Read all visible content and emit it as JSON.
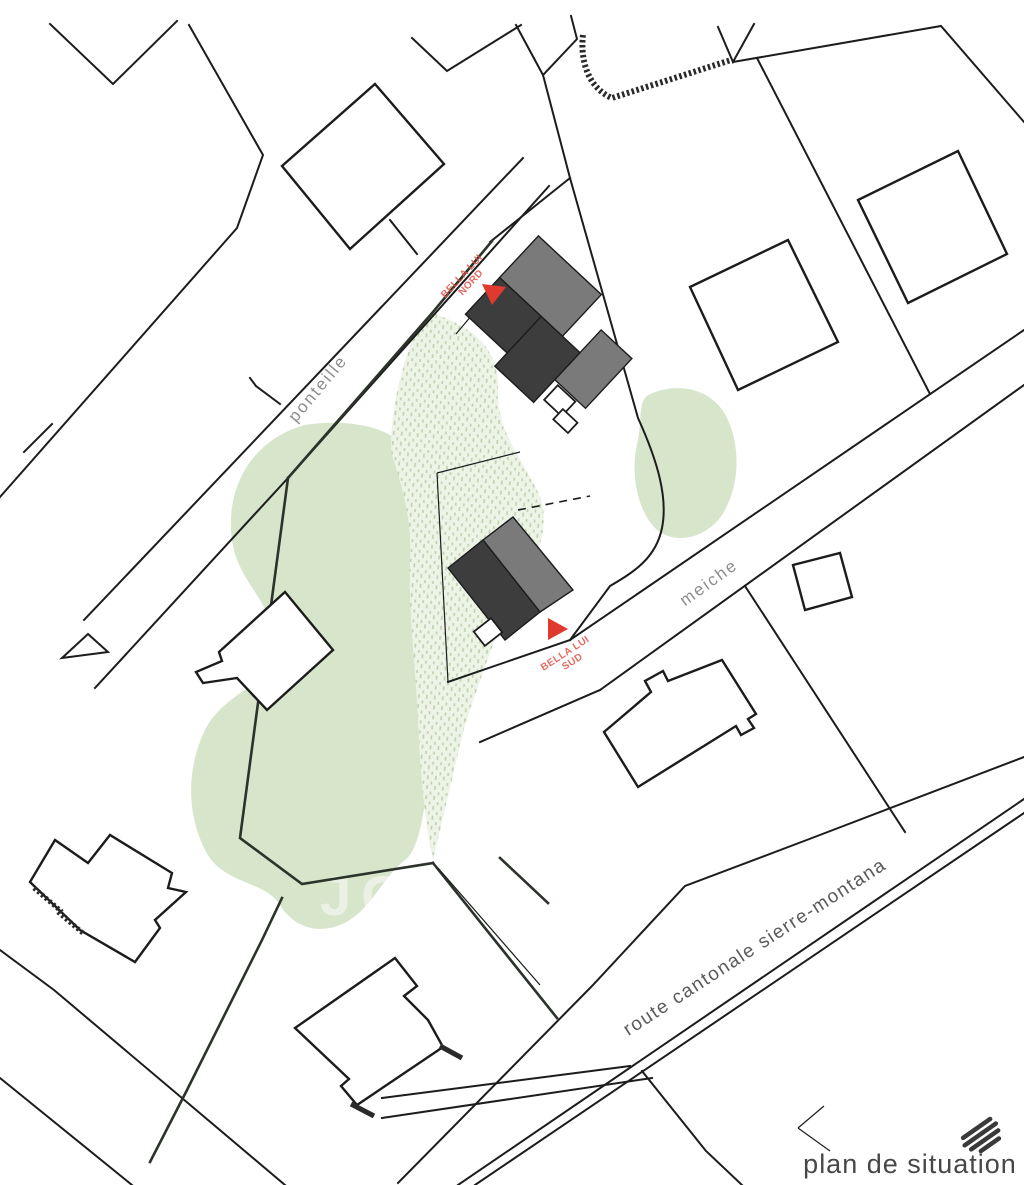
{
  "plan": {
    "title": "plan de situation",
    "watermark": "JOU",
    "streets": {
      "ponteille": "ponteille",
      "meiche": "meiche",
      "route_cantonale": "route cantonale sierre-montana"
    },
    "labels": {
      "north_line1": "BELLA LUI",
      "north_line2": "NORD",
      "south_line1": "BELLA LUI",
      "south_line2": "SUD"
    },
    "colors": {
      "line": "#1c1c1c",
      "parcel_boundary": "#2b332a",
      "building_dark": "#3d3d3d",
      "building_light": "#7a7a7a",
      "green_fill": "#d7e5cb",
      "green_stipple_bg": "#eef3e7",
      "green_stipple_dash": "#bcd3a9",
      "red_marker": "#e0392e",
      "red_label_text": "#e05248",
      "street_text": "#8d8d8d",
      "route_text": "#5a5a5a",
      "title_text": "#474747",
      "logo": "#3a3a3a"
    }
  }
}
